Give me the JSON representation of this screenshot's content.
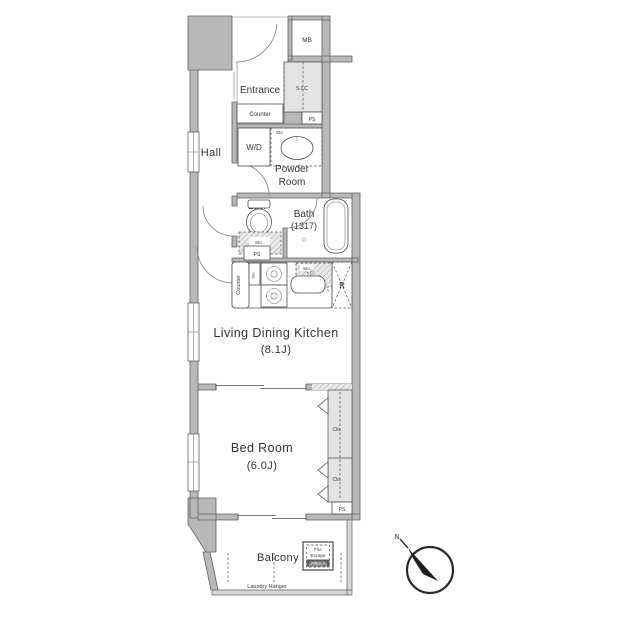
{
  "colors": {
    "wall-fill": "#b8b8b8",
    "wall-stroke": "#606060",
    "light-fill": "#e3e3e3",
    "line-color": "#4d4d4d",
    "door-color": "#8a8a8a",
    "text-color": "#333333"
  },
  "labels": {
    "mb": "MB",
    "entrance": "Entrance",
    "sic": "S.I.C",
    "ps": "PS",
    "counter": "Counter",
    "wd": "W/D",
    "sto": "Sto.",
    "hall": "Hall",
    "powder1": "Powder",
    "powder2": "Room",
    "lav": "Lav.",
    "bath": "Bath",
    "bath_size": "(1317)",
    "bath_star": "☆",
    "refrigerator": "R",
    "ldk": "Living Dining Kitchen",
    "ldk_size": "(8.1J)",
    "bedroom": "Bed Room",
    "bedroom_size": "(6.0J)",
    "closet": "Clo.",
    "balcony": "Balcony",
    "laundry_hanger": "Laundry Hanger",
    "fire_escape1": "Fire",
    "fire_escape2": "Escape",
    "fire_escape3": "(避難器具)",
    "compass_north": "N"
  }
}
